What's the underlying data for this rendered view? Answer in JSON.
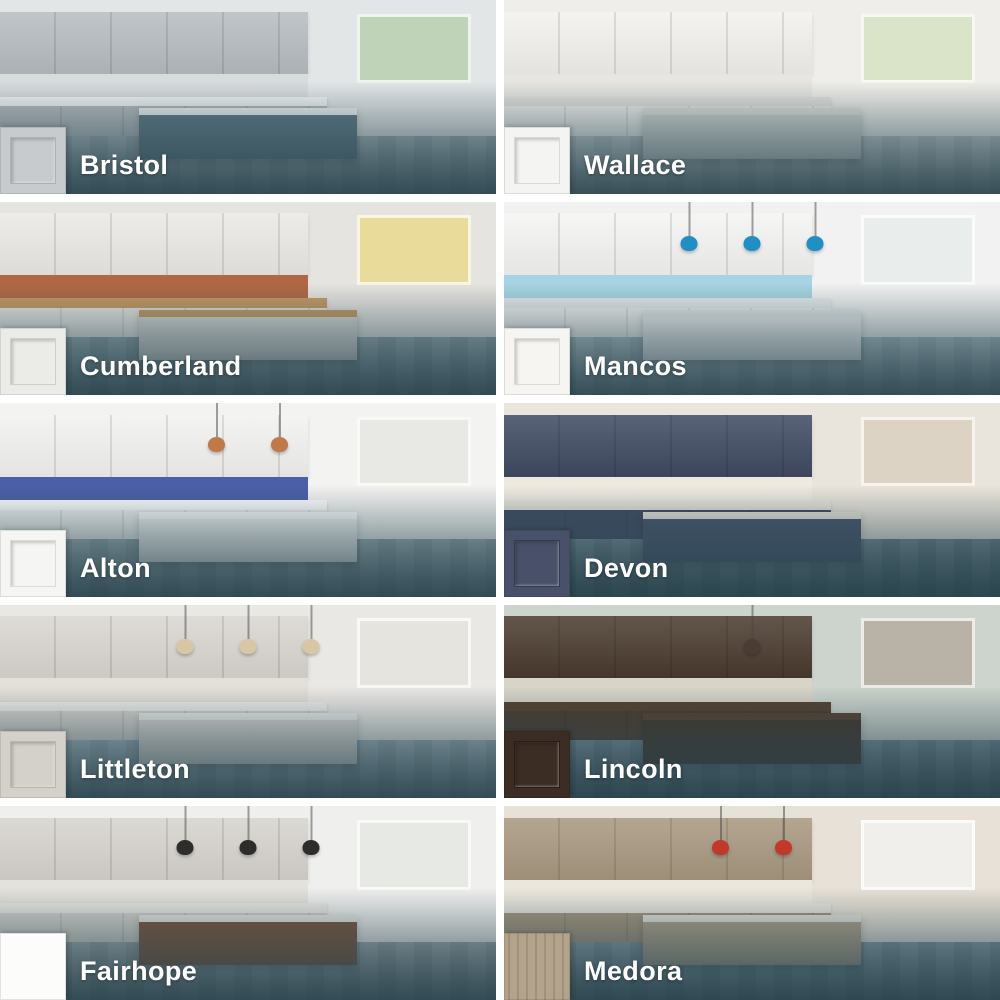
{
  "ui": {
    "background_color": "#ffffff",
    "overlay_color": "#28424c",
    "label_text_color": "#ffffff"
  },
  "tiles": [
    {
      "label": "Bristol",
      "swatch": {
        "type": "shaker",
        "color": "#c8cbcd",
        "edge": "#adb1b4",
        "description": "light gray shaker door sample"
      },
      "photo": {
        "description": "Kitchen with gray perimeter cabinets, stainless range and hood, white counters, slate blue-gray island, window to green yard",
        "pendants": 0,
        "palette": {
          "wall": "#e3e6e7",
          "window": "#bfd3b9",
          "cabinet": "#b6bcc0",
          "splash": "#d9dcdd",
          "counter": "#f3f4f4",
          "island": "#5e7984",
          "floor": "#93a5ac",
          "accent": "#e4c33f"
        }
      }
    },
    {
      "label": "Wallace",
      "swatch": {
        "type": "shaker",
        "color": "#f4f5f3",
        "edge": "#d8dad6",
        "description": "white shaker door sample"
      },
      "photo": {
        "description": "Bright white kitchen with large garden windows, brass faucet, mosaic backsplash, wall oven",
        "pendants": 0,
        "palette": {
          "wall": "#efeeea",
          "window": "#d9e4c8",
          "cabinet": "#f2f1ed",
          "splash": "#e7e6e1",
          "counter": "#e3e2dc",
          "island": "#d3d8d4",
          "floor": "#b9c4c6",
          "accent": "#caa64e"
        }
      }
    },
    {
      "label": "Cumberland",
      "swatch": {
        "type": "shaker",
        "color": "#ebebe7",
        "edge": "#cfcfc9",
        "description": "off-white shaker door sample"
      },
      "photo": {
        "description": "Loft kitchen with white cabinets, stainless fridge, exposed brick windows with autumn foliage, wood breakfast bar with stools, white shelving",
        "pendants": 0,
        "palette": {
          "wall": "#e6e4e0",
          "window": "#e9dc9a",
          "cabinet": "#ebe9e5",
          "splash": "#b06844",
          "counter": "#c79a62",
          "island": "#d9d9d6",
          "floor": "#7e959e",
          "accent": "#2f55a0"
        }
      }
    },
    {
      "label": "Mancos",
      "swatch": {
        "type": "shaker",
        "color": "#f6f5f2",
        "edge": "#dbdad5",
        "description": "white shaker door sample"
      },
      "photo": {
        "description": "White kitchen with light blue backsplash, blue glass pendants over island, stainless fridge",
        "pendants": 3,
        "palette": {
          "wall": "#f1f2f1",
          "window": "#e9edec",
          "cabinet": "#f4f4f2",
          "splash": "#a7d4e2",
          "counter": "#e7ebec",
          "island": "#eff1f1",
          "floor": "#9db3bb",
          "accent": "#1f8fc4"
        }
      }
    },
    {
      "label": "Alton",
      "swatch": {
        "type": "shaker",
        "color": "#f5f5f3",
        "edge": "#dcdcd9",
        "description": "white shaker door sample"
      },
      "photo": {
        "description": "White kitchen with blue patterned tile backsplash, copper wire pendants, stainless fridge, wooden chairs at island, wall art",
        "pendants": 2,
        "palette": {
          "wall": "#f3f3f1",
          "window": "#e8e8e4",
          "cabinet": "#f2f2f0",
          "splash": "#4a5fa5",
          "counter": "#ffffff",
          "island": "#f3f3f1",
          "floor": "#879ca5",
          "accent": "#c07a4a"
        }
      }
    },
    {
      "label": "Devon",
      "swatch": {
        "type": "shaker",
        "color": "#49516a",
        "edge": "#343b4e",
        "description": "navy blue shaker door sample"
      },
      "photo": {
        "description": "Navy blue cabinets with white subway tile, stainless hood, brass hardware, island with stools, window seat with blinds",
        "pendants": 0,
        "palette": {
          "wall": "#eae5dc",
          "window": "#ddd3c4",
          "cabinet": "#3f4a61",
          "splash": "#efeae0",
          "counter": "#e9e5db",
          "island": "#46536b",
          "floor": "#4e6a76",
          "accent": "#bf9352"
        }
      }
    },
    {
      "label": "Littleton",
      "swatch": {
        "type": "shaker",
        "color": "#d4d1ca",
        "edge": "#b9b6ae",
        "description": "light warm gray shaker door sample"
      },
      "photo": {
        "description": "Light gray kitchen with glass pendants, marble island, stainless fridge, open doorway at left",
        "pendants": 3,
        "palette": {
          "wall": "#eae8e4",
          "window": "#e6e4df",
          "cabinet": "#d9d6d0",
          "splash": "#e3e0da",
          "counter": "#efeeeb",
          "island": "#dbd8d2",
          "floor": "#8ea4ad",
          "accent": "#d8c7a4"
        }
      }
    },
    {
      "label": "Lincoln",
      "swatch": {
        "type": "shaker",
        "color": "#3b2c24",
        "edge": "#281d17",
        "description": "dark espresso shaker door sample"
      },
      "photo": {
        "description": "Home office with dark espresso cabinetry, gallery wall of framed photos, desk with chair, floor lamp, black leather chair",
        "pendants": 1,
        "palette": {
          "wall": "#cdd4cd",
          "window": "#b9b3a7",
          "cabinet": "#493a2e",
          "splash": "#d8d4c8",
          "counter": "#54402f",
          "island": "#41332a",
          "floor": "#56707b",
          "accent": "#4a3c33"
        }
      }
    },
    {
      "label": "Fairhope",
      "swatch": {
        "type": "slab",
        "color": "#fcfcfb",
        "edge": "#e8e8e6",
        "description": "white flat slab door sample"
      },
      "photo": {
        "description": "Modern kitchen with greige slab cabinets, black pendants, walnut waterfall island, wooden bar stools, botanical art",
        "pendants": 3,
        "palette": {
          "wall": "#efefed",
          "window": "#e7eae4",
          "cabinet": "#d6d3cd",
          "splash": "#e4e2dd",
          "counter": "#e9e8e4",
          "island": "#7c533b",
          "floor": "#8d989e",
          "accent": "#2e2d2b"
        }
      }
    },
    {
      "label": "Medora",
      "swatch": {
        "type": "wood",
        "color": "#b3a38c",
        "edge": "#a2917a",
        "description": "driftwood woodgrain slab door sample"
      },
      "photo": {
        "description": "Kitchen with driftwood taupe woodgrain cabinets, white subway tile, red pendants, cream swivel bar stools at peninsula, stainless fridge",
        "pendants": 2,
        "palette": {
          "wall": "#e7e1d7",
          "window": "#f0efeb",
          "cabinet": "#a7977f",
          "splash": "#ece7dc",
          "counter": "#e8e5de",
          "island": "#b1a28a",
          "floor": "#6c8590",
          "accent": "#c0392b"
        }
      }
    }
  ]
}
